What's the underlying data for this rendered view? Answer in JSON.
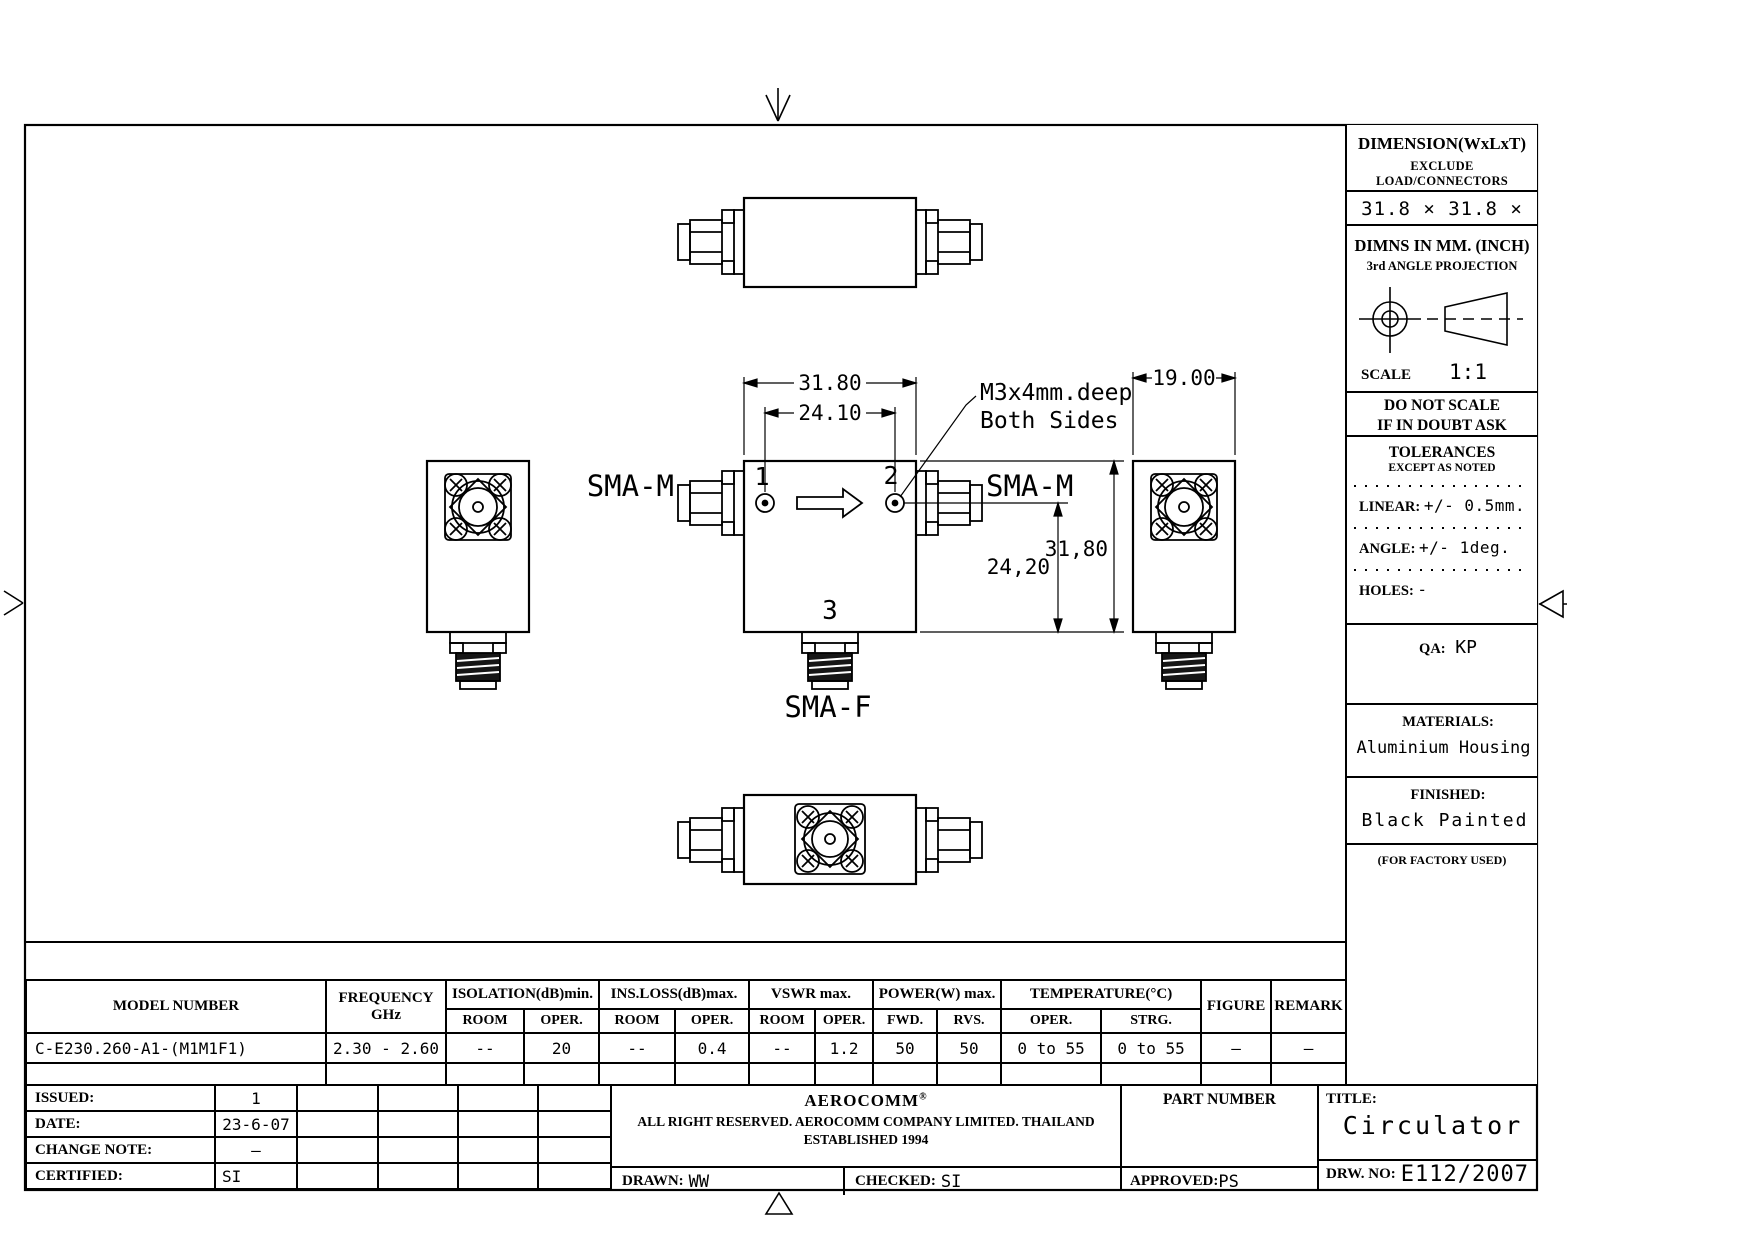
{
  "drawing": {
    "dims": {
      "width_top": "31.80",
      "port_spacing": "24.10",
      "height_right": "31,80",
      "port_height": "24,20",
      "thickness": "19.00"
    },
    "labels": {
      "sma_m_left": "SMA-M",
      "sma_m_right": "SMA-M",
      "sma_f": "SMA-F",
      "port1": "1",
      "port2": "2",
      "port3": "3"
    },
    "note": {
      "line1": "M3x4mm.deep",
      "line2": "Both Sides"
    }
  },
  "info_panel": {
    "dimension_header": "DIMENSION(WxLxT)",
    "dimension_sub": "EXCLUDE LOAD/CONNECTORS",
    "dimension_value": "31.8 × 31.8 × 19",
    "units_line1": "DIMNS IN MM. (INCH)",
    "units_line2": "3rd ANGLE PROJECTION",
    "scale_label": "SCALE",
    "scale_value": "1:1",
    "do_not_scale_line1": "DO NOT SCALE",
    "do_not_scale_line2": "IF IN DOUBT ASK",
    "tolerances_header": "TOLERANCES",
    "tolerances_sub": "EXCEPT AS NOTED",
    "linear_label": "LINEAR:",
    "linear_value": "+/-  0.5mm.",
    "angle_label": "ANGLE:",
    "angle_value": "+/-  1deg.",
    "holes_label": "HOLES:",
    "holes_value": "-",
    "qa_label": "QA:",
    "qa_value": "KP",
    "materials_label": "MATERIALS:",
    "materials_value": "Aluminium Housing",
    "finished_label": "FINISHED:",
    "finished_value": "Black Painted",
    "factory_note": "(FOR FACTORY USED)"
  },
  "spec_table": {
    "headers": {
      "model_number": "MODEL NUMBER",
      "frequency_line1": "FREQUENCY",
      "frequency_line2": "GHz",
      "isolation": "ISOLATION(dB)min.",
      "ins_loss": "INS.LOSS(dB)max.",
      "vswr": "VSWR  max.",
      "power": "POWER(W)  max.",
      "temperature": "TEMPERATURE(°C)",
      "figure": "FIGURE",
      "remark": "REMARK",
      "sub": [
        "ROOM",
        "OPER.",
        "ROOM",
        "OPER.",
        "ROOM",
        "OPER.",
        "FWD.",
        "RVS.",
        "OPER.",
        "STRG."
      ]
    },
    "row": {
      "model_number": "C-E230.260-A1-(M1M1F1)",
      "frequency": "2.30 - 2.60",
      "isolation_room": "--",
      "isolation_oper": "20",
      "ins_loss_room": "--",
      "ins_loss_oper": "0.4",
      "vswr_room": "--",
      "vswr_oper": "1.2",
      "power_fwd": "50",
      "power_rvs": "50",
      "temp_oper": "0 to 55",
      "temp_strg": "0 to 55",
      "figure": "—",
      "remark": "—"
    }
  },
  "title_block": {
    "issued_label": "ISSUED:",
    "issued_value": "1",
    "date_label": "DATE:",
    "date_value": "23-6-07",
    "change_note_label": "CHANGE NOTE:",
    "change_note_value": "–",
    "certified_label": "CERTIFIED:",
    "certified_value": "SI",
    "company_name": "AEROCOMM",
    "company_reg": "®",
    "company_line2": "ALL RIGHT RESERVED.  AEROCOMM COMPANY LIMITED.  THAILAND",
    "company_line3": "ESTABLISHED 1994",
    "drawn_label": "DRAWN:",
    "drawn_value": "WW",
    "checked_label": "CHECKED:",
    "checked_value": "SI",
    "approved_label": "APPROVED:",
    "approved_value": "PS",
    "part_number_label": "PART NUMBER",
    "title_label": "TITLE:",
    "title_value": "Circulator",
    "drw_no_label": "DRW. NO:",
    "drw_no_value": "E112/2007"
  }
}
